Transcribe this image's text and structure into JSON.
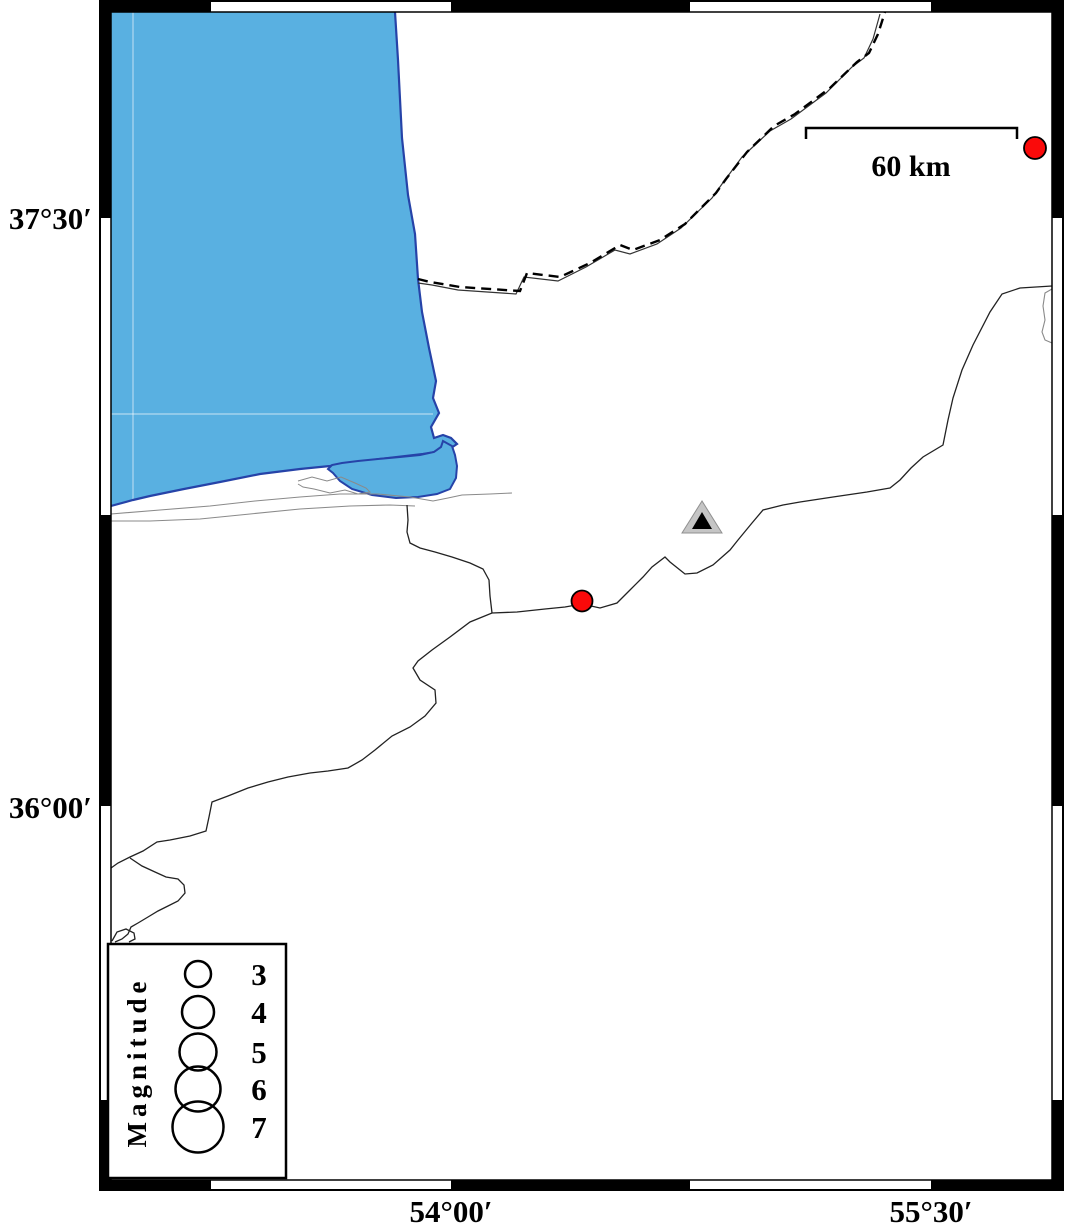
{
  "figure": {
    "type": "seismicity-map",
    "axis": {
      "lat_labels": [
        {
          "text": "37°30′"
        },
        {
          "text": "36°00′"
        }
      ],
      "lon_labels": [
        {
          "text": "54°00′"
        },
        {
          "text": "55°30′"
        }
      ]
    },
    "scale_bar": {
      "label": "60 km"
    },
    "legend": {
      "title": "Magnitude",
      "entries": [
        {
          "mag": "3",
          "r": 13
        },
        {
          "mag": "4",
          "r": 16
        },
        {
          "mag": "5",
          "r": 18.5
        },
        {
          "mag": "6",
          "r": 22.5
        },
        {
          "mag": "7",
          "r": 25.5
        }
      ]
    },
    "markers": {
      "earthquakes": [
        {
          "x": 1035,
          "y": 148,
          "r": 11
        },
        {
          "x": 582,
          "y": 601,
          "r": 10.5
        }
      ],
      "station": {
        "x": 702,
        "y": 517
      }
    },
    "colors": {
      "sea": "#59b0e1",
      "coast": "#2643a8",
      "earthquake": "#fa0a0a",
      "station": "#c5c5c5",
      "frame": "#000000"
    }
  }
}
